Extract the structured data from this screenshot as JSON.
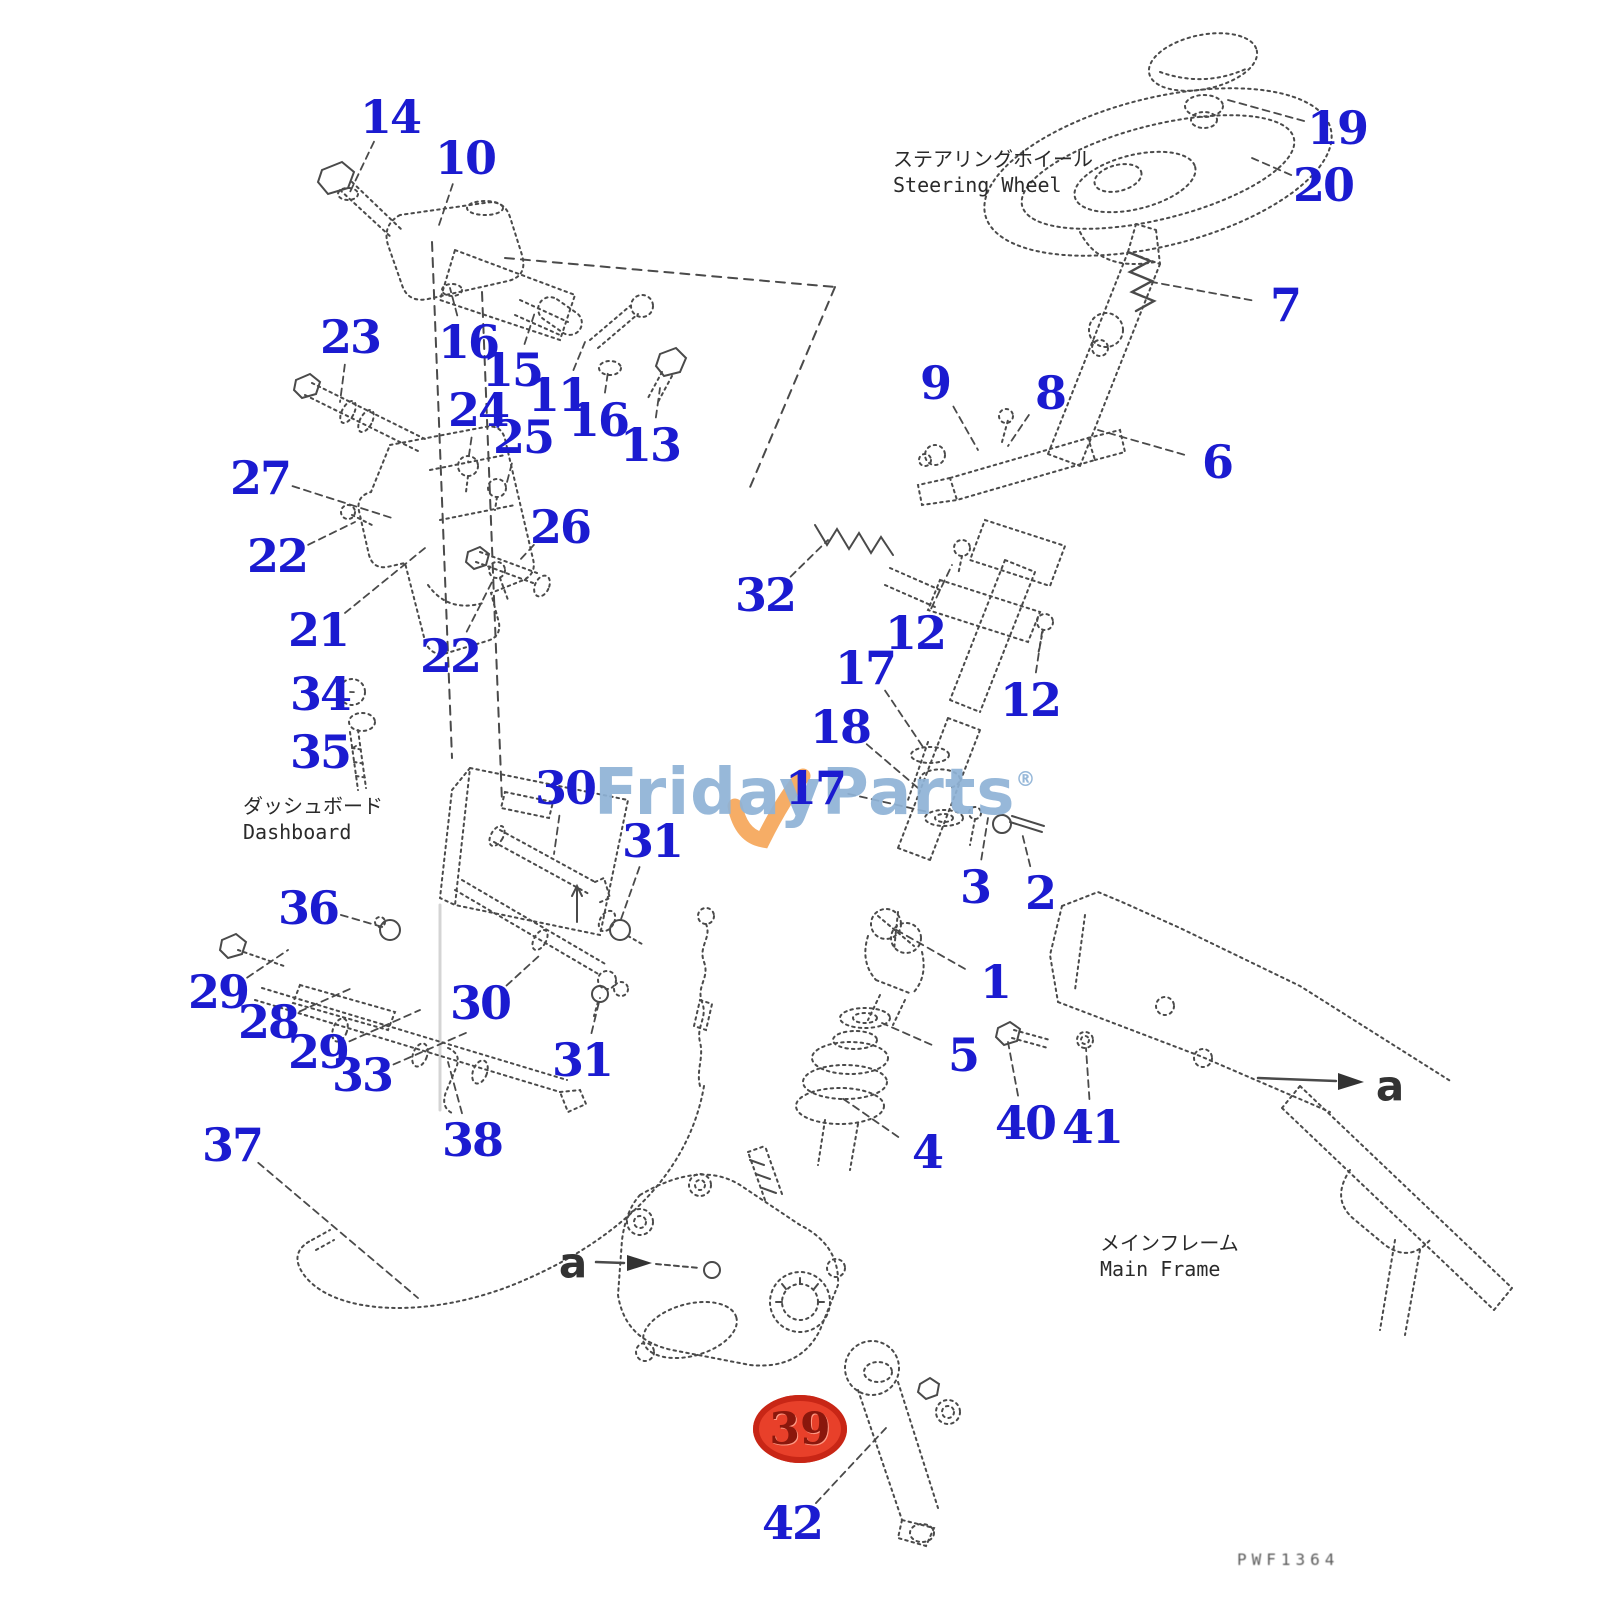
{
  "page": {
    "width": 1600,
    "height": 1600,
    "background": "#ffffff"
  },
  "branding": {
    "watermark_text": "FridayParts",
    "registered_mark": "®",
    "watermark_color": "#8fb3d6",
    "swoosh_color": "#f5a95e"
  },
  "drawing_code": "PWF1364",
  "colors": {
    "callout": "#1b1bd0",
    "line": "#4a4a4a",
    "highlight_fill": "#e8402a",
    "highlight_text": "#8a170c"
  },
  "area_labels": [
    {
      "name": "steering-wheel",
      "jp": "ステアリングホイール",
      "en": "Steering Wheel",
      "x": 893,
      "y": 146
    },
    {
      "name": "dashboard",
      "jp": "ダッシュボード",
      "en": "Dashboard",
      "x": 243,
      "y": 793
    },
    {
      "name": "main-frame",
      "jp": "メインフレーム",
      "en": "Main Frame",
      "x": 1100,
      "y": 1230
    }
  ],
  "section_markers": [
    {
      "label": "a",
      "x": 573,
      "y": 1263
    },
    {
      "label": "a",
      "x": 1390,
      "y": 1086
    }
  ],
  "highlighted_callout": {
    "label": "39",
    "x": 800,
    "y": 1429
  },
  "callouts": [
    {
      "label": "14",
      "x": 390,
      "y": 117,
      "tx": 350,
      "ty": 192
    },
    {
      "label": "10",
      "x": 465,
      "y": 158,
      "tx": 438,
      "ty": 228
    },
    {
      "label": "23",
      "x": 350,
      "y": 337,
      "tx": 340,
      "ty": 402
    },
    {
      "label": "16",
      "x": 468,
      "y": 342,
      "tx": 450,
      "ty": 288
    },
    {
      "label": "15",
      "x": 512,
      "y": 370,
      "tx": 535,
      "ty": 312
    },
    {
      "label": "11",
      "x": 558,
      "y": 395,
      "tx": 585,
      "ty": 342
    },
    {
      "label": "16",
      "x": 598,
      "y": 420,
      "tx": 608,
      "ty": 372
    },
    {
      "label": "13",
      "x": 650,
      "y": 445,
      "tx": 660,
      "ty": 388
    },
    {
      "label": "24",
      "x": 478,
      "y": 410,
      "tx": 468,
      "ty": 462
    },
    {
      "label": "25",
      "x": 523,
      "y": 437,
      "tx": 506,
      "ty": 486
    },
    {
      "label": "27",
      "x": 260,
      "y": 478,
      "tx": 392,
      "ty": 518
    },
    {
      "label": "22",
      "x": 277,
      "y": 556,
      "tx": 355,
      "ty": 522
    },
    {
      "label": "26",
      "x": 560,
      "y": 527,
      "tx": 518,
      "ty": 562
    },
    {
      "label": "21",
      "x": 318,
      "y": 630,
      "tx": 425,
      "ty": 548
    },
    {
      "label": "22",
      "x": 450,
      "y": 656,
      "tx": 494,
      "ty": 578
    },
    {
      "label": "34",
      "x": 320,
      "y": 694,
      "tx": 350,
      "ty": 692
    },
    {
      "label": "35",
      "x": 320,
      "y": 752,
      "tx": 356,
      "ty": 746
    },
    {
      "label": "30",
      "x": 565,
      "y": 788,
      "tx": 554,
      "ty": 854
    },
    {
      "label": "31",
      "x": 652,
      "y": 841,
      "tx": 620,
      "ty": 922
    },
    {
      "label": "36",
      "x": 308,
      "y": 908,
      "tx": 386,
      "ty": 928
    },
    {
      "label": "29",
      "x": 218,
      "y": 992,
      "tx": 288,
      "ty": 950
    },
    {
      "label": "28",
      "x": 268,
      "y": 1022,
      "tx": 352,
      "ty": 988
    },
    {
      "label": "29",
      "x": 318,
      "y": 1052,
      "tx": 420,
      "ty": 1010
    },
    {
      "label": "33",
      "x": 362,
      "y": 1075,
      "tx": 468,
      "ty": 1032
    },
    {
      "label": "30",
      "x": 480,
      "y": 1003,
      "tx": 540,
      "ty": 955
    },
    {
      "label": "31",
      "x": 582,
      "y": 1060,
      "tx": 600,
      "ty": 998
    },
    {
      "label": "37",
      "x": 232,
      "y": 1145,
      "tx": 418,
      "ty": 1298
    },
    {
      "label": "38",
      "x": 472,
      "y": 1140,
      "tx": 448,
      "ty": 1062
    },
    {
      "label": "9",
      "x": 935,
      "y": 383,
      "tx": 978,
      "ty": 450
    },
    {
      "label": "8",
      "x": 1050,
      "y": 393,
      "tx": 1008,
      "ty": 446
    },
    {
      "label": "6",
      "x": 1217,
      "y": 462,
      "tx": 1098,
      "ty": 430
    },
    {
      "label": "19",
      "x": 1337,
      "y": 128,
      "tx": 1228,
      "ty": 100
    },
    {
      "label": "20",
      "x": 1323,
      "y": 185,
      "tx": 1252,
      "ty": 158
    },
    {
      "label": "7",
      "x": 1285,
      "y": 305,
      "tx": 1152,
      "ty": 282
    },
    {
      "label": "32",
      "x": 765,
      "y": 595,
      "tx": 828,
      "ty": 540
    },
    {
      "label": "12",
      "x": 915,
      "y": 633,
      "tx": 952,
      "ty": 565
    },
    {
      "label": "12",
      "x": 1030,
      "y": 700,
      "tx": 1042,
      "ty": 632
    },
    {
      "label": "17",
      "x": 865,
      "y": 668,
      "tx": 925,
      "ty": 750
    },
    {
      "label": "18",
      "x": 840,
      "y": 727,
      "tx": 918,
      "ty": 788
    },
    {
      "label": "17",
      "x": 815,
      "y": 788,
      "tx": 928,
      "ty": 812
    },
    {
      "label": "3",
      "x": 975,
      "y": 887,
      "tx": 988,
      "ty": 818
    },
    {
      "label": "2",
      "x": 1040,
      "y": 893,
      "tx": 1022,
      "ty": 833
    },
    {
      "label": "1",
      "x": 995,
      "y": 982,
      "tx": 893,
      "ty": 928
    },
    {
      "label": "5",
      "x": 963,
      "y": 1055,
      "tx": 882,
      "ty": 1023
    },
    {
      "label": "4",
      "x": 927,
      "y": 1152,
      "tx": 842,
      "ty": 1098
    },
    {
      "label": "40",
      "x": 1025,
      "y": 1123,
      "tx": 1008,
      "ty": 1042
    },
    {
      "label": "41",
      "x": 1092,
      "y": 1127,
      "tx": 1086,
      "ty": 1048
    },
    {
      "label": "42",
      "x": 792,
      "y": 1523,
      "tx": 886,
      "ty": 1428
    }
  ]
}
